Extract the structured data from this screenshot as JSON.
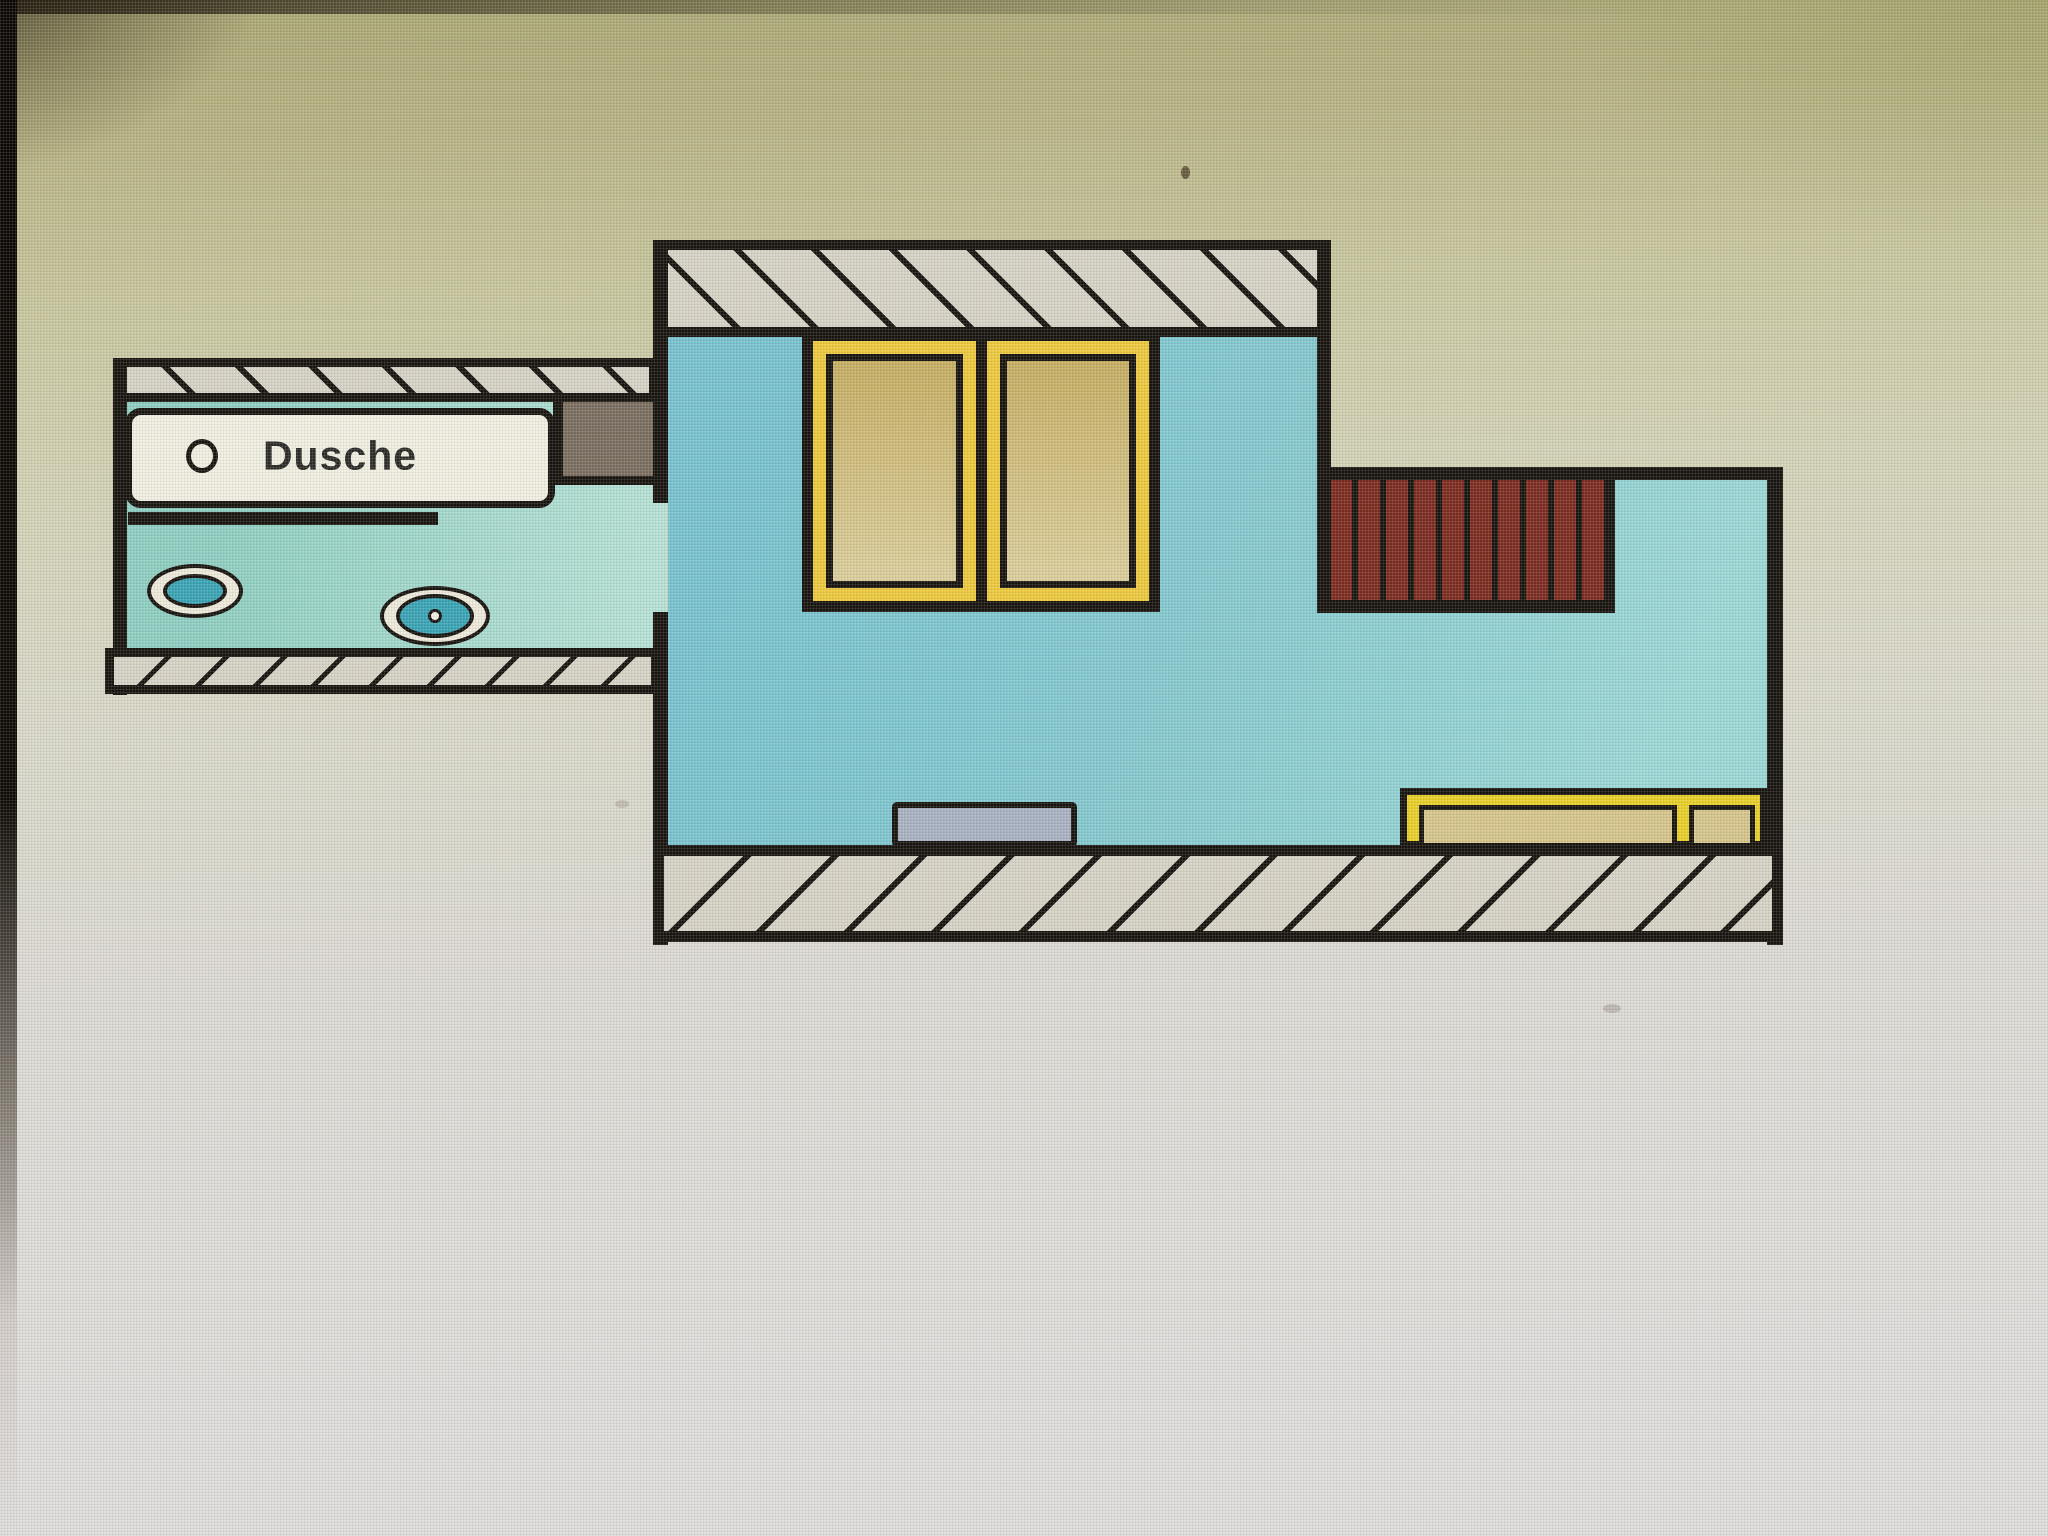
{
  "screen": {
    "description": "Photograph of a monitor displaying a hand-drawn floor plan",
    "width_px": 2048,
    "height_px": 1536
  },
  "plan": {
    "labels": {
      "shower": "Dusche"
    },
    "rooms": [
      {
        "name": "bathroom",
        "floor": "teal"
      },
      {
        "name": "main-room",
        "floor": "teal"
      }
    ],
    "elements": [
      {
        "name": "shower-tray",
        "label": "Dusche",
        "type": "fixture"
      },
      {
        "name": "shower-drain",
        "type": "icon"
      },
      {
        "name": "shower-partition-wall",
        "type": "wall"
      },
      {
        "name": "sink",
        "type": "fixture"
      },
      {
        "name": "toilet",
        "type": "fixture"
      },
      {
        "name": "duct-block",
        "type": "block"
      },
      {
        "name": "door-opening",
        "type": "opening"
      },
      {
        "name": "wardrobe-unit",
        "type": "furniture",
        "panels": 2
      },
      {
        "name": "stairs",
        "type": "stairs",
        "treads": 10
      },
      {
        "name": "shelf",
        "type": "furniture"
      },
      {
        "name": "sideboard",
        "type": "furniture",
        "sections": 2
      }
    ]
  },
  "colors": {
    "ink": "#17130e",
    "wall-fill": "#d7d3c6",
    "floor-b": "#79c3cf",
    "floor-c": "#9cd8d6",
    "bath-a": "#8fcfc2",
    "bath-b": "#b7e2d6",
    "stairs-red": "#7c2b20",
    "window-yellow": "#edc93d",
    "window-tan-a": "#c6ae62",
    "window-tan-b": "#dccf9d",
    "sideboard-yellow": "#e9d028",
    "sideboard-tan": "#d6c58c",
    "shelf-gray": "#a9b2c2",
    "block-gray": "#7b6e60",
    "fixture-shell": "#eeeadb",
    "fixture-teal": "#3aa4b4",
    "shower-white": "#f2efe2",
    "label-ink": "#2b2a26",
    "bg-olive": "#a9a673",
    "bg-mid": "#d9d8c8",
    "bg-bottom": "#dfddd9"
  }
}
